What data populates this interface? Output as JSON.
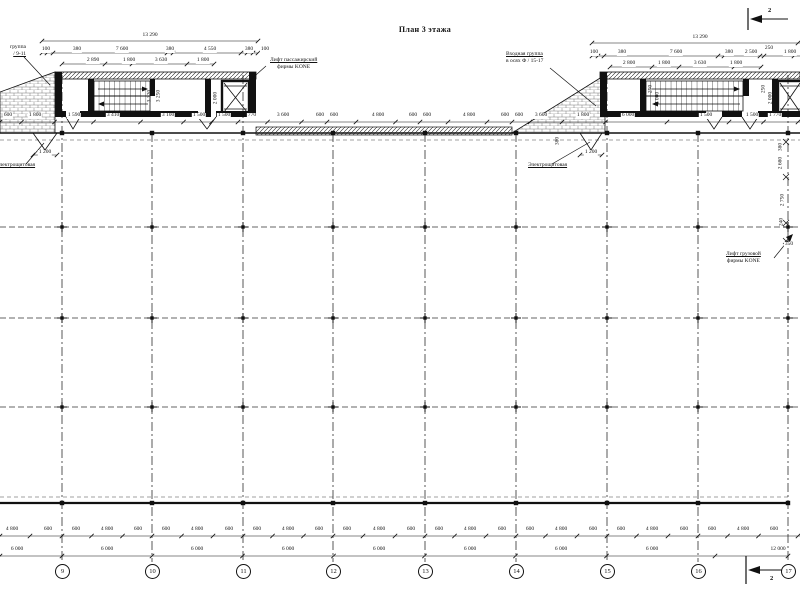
{
  "title": {
    "text": "План 3 этажа"
  },
  "section_markers": [
    {
      "label": "2",
      "x": 768,
      "y": 7
    },
    {
      "label": "2",
      "x": 770,
      "y": 575
    }
  ],
  "axis_bubbles": {
    "y": 571,
    "items": [
      {
        "x": 62,
        "label": "9"
      },
      {
        "x": 152,
        "label": "10"
      },
      {
        "x": 243,
        "label": "11"
      },
      {
        "x": 333,
        "label": "12"
      },
      {
        "x": 425,
        "label": "13"
      },
      {
        "x": 516,
        "label": "14"
      },
      {
        "x": 607,
        "label": "15"
      },
      {
        "x": 698,
        "label": "16"
      },
      {
        "x": 788,
        "label": "17"
      }
    ]
  },
  "annotations": {
    "entrance_left": {
      "x": 26,
      "y": 44,
      "align": "right",
      "underline": 1,
      "lines": [
        "группа",
        "/ 9-11"
      ]
    },
    "entrance_right": {
      "x": 506,
      "y": 51,
      "align": "left",
      "underline": 0,
      "lines": [
        "Входная группа",
        "в осях Ф / 15-17"
      ]
    },
    "elevator_passenger": {
      "x": 270,
      "y": 57,
      "align": "center",
      "underline": 0,
      "lines": [
        "Лифт пассажирский",
        "фирмы KONE"
      ]
    },
    "elevator_freight": {
      "x": 726,
      "y": 251,
      "align": "center",
      "underline": 0,
      "lines": [
        "Лифт грузовой",
        "фирмы KONE"
      ]
    },
    "electrical_left": {
      "x": -4,
      "y": 162,
      "align": "left",
      "underline": 0,
      "lines": [
        "Электрощитовая"
      ]
    },
    "electrical_right": {
      "x": 528,
      "y": 162,
      "align": "left",
      "underline": 0,
      "lines": [
        "Электрощитовая"
      ]
    }
  },
  "dimensions": {
    "core_left_top": [
      {
        "x": 150,
        "y": 33,
        "t": "13 290"
      },
      {
        "x": 46,
        "y": 47,
        "t": "100"
      },
      {
        "x": 77,
        "y": 47,
        "t": "380"
      },
      {
        "x": 122,
        "y": 47,
        "t": "7 600"
      },
      {
        "x": 170,
        "y": 47,
        "t": "380"
      },
      {
        "x": 210,
        "y": 47,
        "t": "4 550"
      },
      {
        "x": 249,
        "y": 47,
        "t": "380"
      },
      {
        "x": 265,
        "y": 47,
        "t": "100"
      },
      {
        "x": 93,
        "y": 58,
        "t": "2 890"
      },
      {
        "x": 129,
        "y": 58,
        "t": "1 800"
      },
      {
        "x": 161,
        "y": 58,
        "t": "3 630"
      },
      {
        "x": 203,
        "y": 58,
        "t": "1 800"
      }
    ],
    "core_right_top": [
      {
        "x": 700,
        "y": 35,
        "t": "13 290"
      },
      {
        "x": 594,
        "y": 50,
        "t": "100"
      },
      {
        "x": 622,
        "y": 50,
        "t": "380"
      },
      {
        "x": 676,
        "y": 50,
        "t": "7 600"
      },
      {
        "x": 729,
        "y": 50,
        "t": "380"
      },
      {
        "x": 751,
        "y": 50,
        "t": "2 500"
      },
      {
        "x": 769,
        "y": 46,
        "t": "250"
      },
      {
        "x": 790,
        "y": 50,
        "t": "1 800"
      },
      {
        "x": 629,
        "y": 61,
        "t": "2 800"
      },
      {
        "x": 664,
        "y": 61,
        "t": "1 800"
      },
      {
        "x": 700,
        "y": 61,
        "t": "3 630"
      },
      {
        "x": 736,
        "y": 61,
        "t": "1 800"
      }
    ],
    "top_row": [
      {
        "x": 8,
        "y": 113,
        "t": "600"
      },
      {
        "x": 35,
        "y": 113,
        "t": "1 800"
      },
      {
        "x": 74,
        "y": 113,
        "t": "1 590"
      },
      {
        "x": 113,
        "y": 113,
        "t": "3 410"
      },
      {
        "x": 168,
        "y": 113,
        "t": "3 100"
      },
      {
        "x": 199,
        "y": 113,
        "t": "1 500"
      },
      {
        "x": 224,
        "y": 113,
        "t": "1 500"
      },
      {
        "x": 252,
        "y": 113,
        "t": "770"
      },
      {
        "x": 283,
        "y": 113,
        "t": "3 600"
      },
      {
        "x": 320,
        "y": 113,
        "t": "600"
      },
      {
        "x": 334,
        "y": 113,
        "t": "600"
      },
      {
        "x": 378,
        "y": 113,
        "t": "4 800"
      },
      {
        "x": 413,
        "y": 113,
        "t": "600"
      },
      {
        "x": 427,
        "y": 113,
        "t": "600"
      },
      {
        "x": 469,
        "y": 113,
        "t": "4 800"
      },
      {
        "x": 505,
        "y": 113,
        "t": "600"
      },
      {
        "x": 519,
        "y": 113,
        "t": "600"
      },
      {
        "x": 541,
        "y": 113,
        "t": "3 600"
      },
      {
        "x": 583,
        "y": 113,
        "t": "1 800"
      },
      {
        "x": 628,
        "y": 113,
        "t": "6 000"
      },
      {
        "x": 706,
        "y": 113,
        "t": "1 500"
      },
      {
        "x": 752,
        "y": 113,
        "t": "1 500"
      },
      {
        "x": 775,
        "y": 113,
        "t": "1 770"
      }
    ],
    "bottom_row1": [
      {
        "x": 12,
        "y": 527,
        "t": "4 800"
      },
      {
        "x": 48,
        "y": 527,
        "t": "600"
      },
      {
        "x": 76,
        "y": 527,
        "t": "600"
      },
      {
        "x": 107,
        "y": 527,
        "t": "4 800"
      },
      {
        "x": 138,
        "y": 527,
        "t": "600"
      },
      {
        "x": 166,
        "y": 527,
        "t": "600"
      },
      {
        "x": 197,
        "y": 527,
        "t": "4 800"
      },
      {
        "x": 229,
        "y": 527,
        "t": "600"
      },
      {
        "x": 257,
        "y": 527,
        "t": "600"
      },
      {
        "x": 288,
        "y": 527,
        "t": "4 800"
      },
      {
        "x": 319,
        "y": 527,
        "t": "600"
      },
      {
        "x": 347,
        "y": 527,
        "t": "600"
      },
      {
        "x": 379,
        "y": 527,
        "t": "4 800"
      },
      {
        "x": 411,
        "y": 527,
        "t": "600"
      },
      {
        "x": 439,
        "y": 527,
        "t": "600"
      },
      {
        "x": 470,
        "y": 527,
        "t": "4 800"
      },
      {
        "x": 502,
        "y": 527,
        "t": "600"
      },
      {
        "x": 530,
        "y": 527,
        "t": "600"
      },
      {
        "x": 561,
        "y": 527,
        "t": "4 800"
      },
      {
        "x": 593,
        "y": 527,
        "t": "600"
      },
      {
        "x": 621,
        "y": 527,
        "t": "600"
      },
      {
        "x": 652,
        "y": 527,
        "t": "4 800"
      },
      {
        "x": 684,
        "y": 527,
        "t": "600"
      },
      {
        "x": 712,
        "y": 527,
        "t": "600"
      },
      {
        "x": 743,
        "y": 527,
        "t": "4 800"
      },
      {
        "x": 774,
        "y": 527,
        "t": "600"
      }
    ],
    "bottom_row2": [
      {
        "x": 17,
        "y": 547,
        "t": "6 000"
      },
      {
        "x": 107,
        "y": 547,
        "t": "6 000"
      },
      {
        "x": 197,
        "y": 547,
        "t": "6 000"
      },
      {
        "x": 288,
        "y": 547,
        "t": "6 000"
      },
      {
        "x": 379,
        "y": 547,
        "t": "6 000"
      },
      {
        "x": 470,
        "y": 547,
        "t": "6 000"
      },
      {
        "x": 561,
        "y": 547,
        "t": "6 000"
      },
      {
        "x": 652,
        "y": 547,
        "t": "6 000"
      },
      {
        "x": 778,
        "y": 547,
        "t": "12 000"
      }
    ],
    "vertical": [
      {
        "x": 150,
        "y": 96,
        "t": "3 320"
      },
      {
        "x": 159,
        "y": 96,
        "t": "3 250"
      },
      {
        "x": 209,
        "y": 89,
        "t": "250"
      },
      {
        "x": 216,
        "y": 98,
        "t": "2 000"
      },
      {
        "x": 651,
        "y": 89,
        "t": "250"
      },
      {
        "x": 658,
        "y": 98,
        "t": "2 000"
      },
      {
        "x": 764,
        "y": 89,
        "t": "250"
      },
      {
        "x": 771,
        "y": 98,
        "t": "2 000"
      },
      {
        "x": 558,
        "y": 141,
        "t": "380"
      },
      {
        "x": 781,
        "y": 147,
        "t": "380"
      },
      {
        "x": 781,
        "y": 163,
        "t": "2 680"
      },
      {
        "x": 783,
        "y": 200,
        "t": "2 750"
      },
      {
        "x": 782,
        "y": 222,
        "t": "240"
      }
    ],
    "misc": [
      {
        "x": 45,
        "y": 150,
        "t": "1 200"
      },
      {
        "x": 591,
        "y": 150,
        "t": "1 200"
      },
      {
        "x": 789,
        "y": 242,
        "t": "350"
      }
    ]
  }
}
